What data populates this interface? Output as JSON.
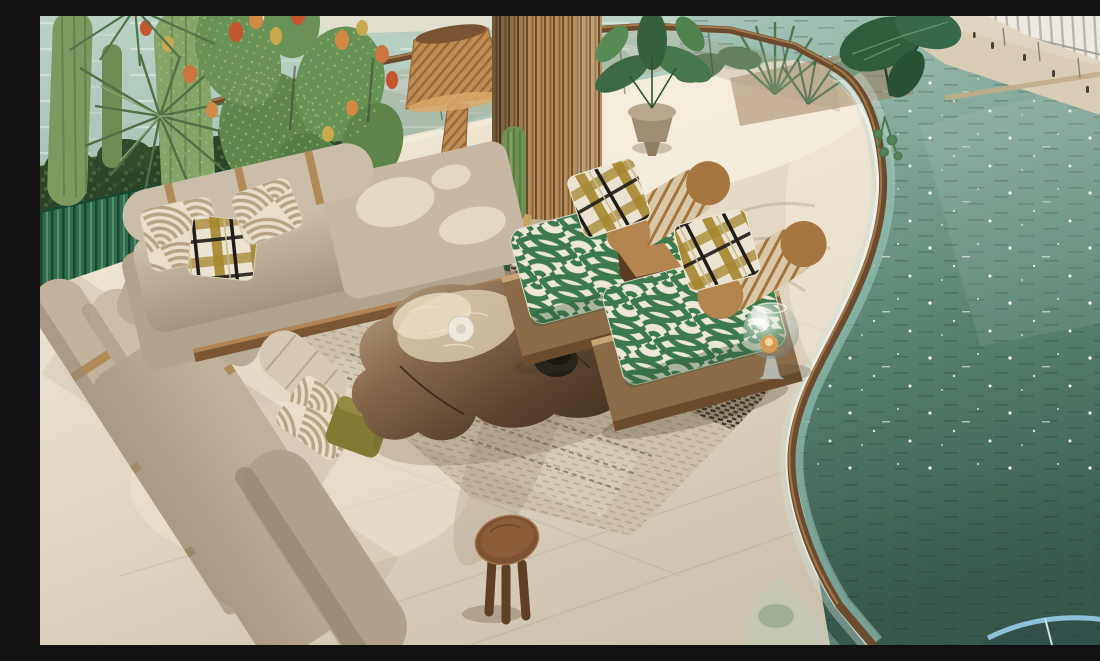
{
  "meta": {
    "type": "natural-image",
    "description": "Aerial 3D render of a luxury waterfront terrace lounge: L-shaped beige sectional sofa with patterned pillows, live-edge walnut coffee table on a woven rug, two green fan-patterned lounge chairs with plaid pillows, fluted wood column, rattan cone floor lamp, prickly-pear cactus planter, curved glass balustrade with bronze handrail, teal canal water and a white building with a promenade across the canal."
  },
  "palette": {
    "water_light": "#aac8bc",
    "water_deep": "#3c6254",
    "floor_cream": "#e3d9c6",
    "sofa_beige": "#b3a28c",
    "sofa_light": "#cbbda7",
    "cushion_green": "#3c7a4b",
    "cushion_cream": "#ece7d6",
    "planter_green": "#2f6b4c",
    "bush_green": "#2b4426",
    "cactus_green": "#6f9153",
    "wood_walnut": "#5a4029",
    "wood_column": "#b88e5c",
    "wood_platform": "#8a6a47",
    "leather_tan": "#b5854f",
    "handrail_bronze": "#6b4a2d",
    "building_white": "#eceae3",
    "quay_sand": "#e0d5c0",
    "stool_wood": "#7d5232",
    "rug_base": "#cdc1aa",
    "rug_trim_green": "#2a4f38",
    "olive_pillow": "#827a32",
    "glass_teal": "#9fc5bb"
  },
  "objects": {
    "water_canal": "teal canal water with sun sparkles",
    "building": "white modern building across the canal",
    "promenade": "sand-colored quay promenade with pedestrians and lamp posts",
    "terrace_floor": "cream travertine terrace floor",
    "glass_balustrade": "curved glass balustrade with bronze handrail",
    "planter": "green corrugated planter with bushes, columnar cacti, prickly pear and yucca",
    "floor_lamp": "rattan cone floor lamp",
    "column": "fluted wooden column",
    "sofa": "L-shaped beige sectional sofa with bolster backrests and leather straps",
    "pillows": "arc-striped, olive-black plaid and olive green pillows",
    "rug": "woven beige rug with dark herringbone bands and green trim",
    "coffee_table": "live-edge walnut slab coffee table with hide throw, white dish and black bowl",
    "lounge_chairs": "two lounge chairs with green fan-pattern cushions and tan bolsters",
    "side_table": "wooden cube side table",
    "lantern": "glass sphere candle lantern",
    "stool": "round wooden stool",
    "potted_plants": "stone urn with tropical plants, palms and alocasia leaves"
  }
}
